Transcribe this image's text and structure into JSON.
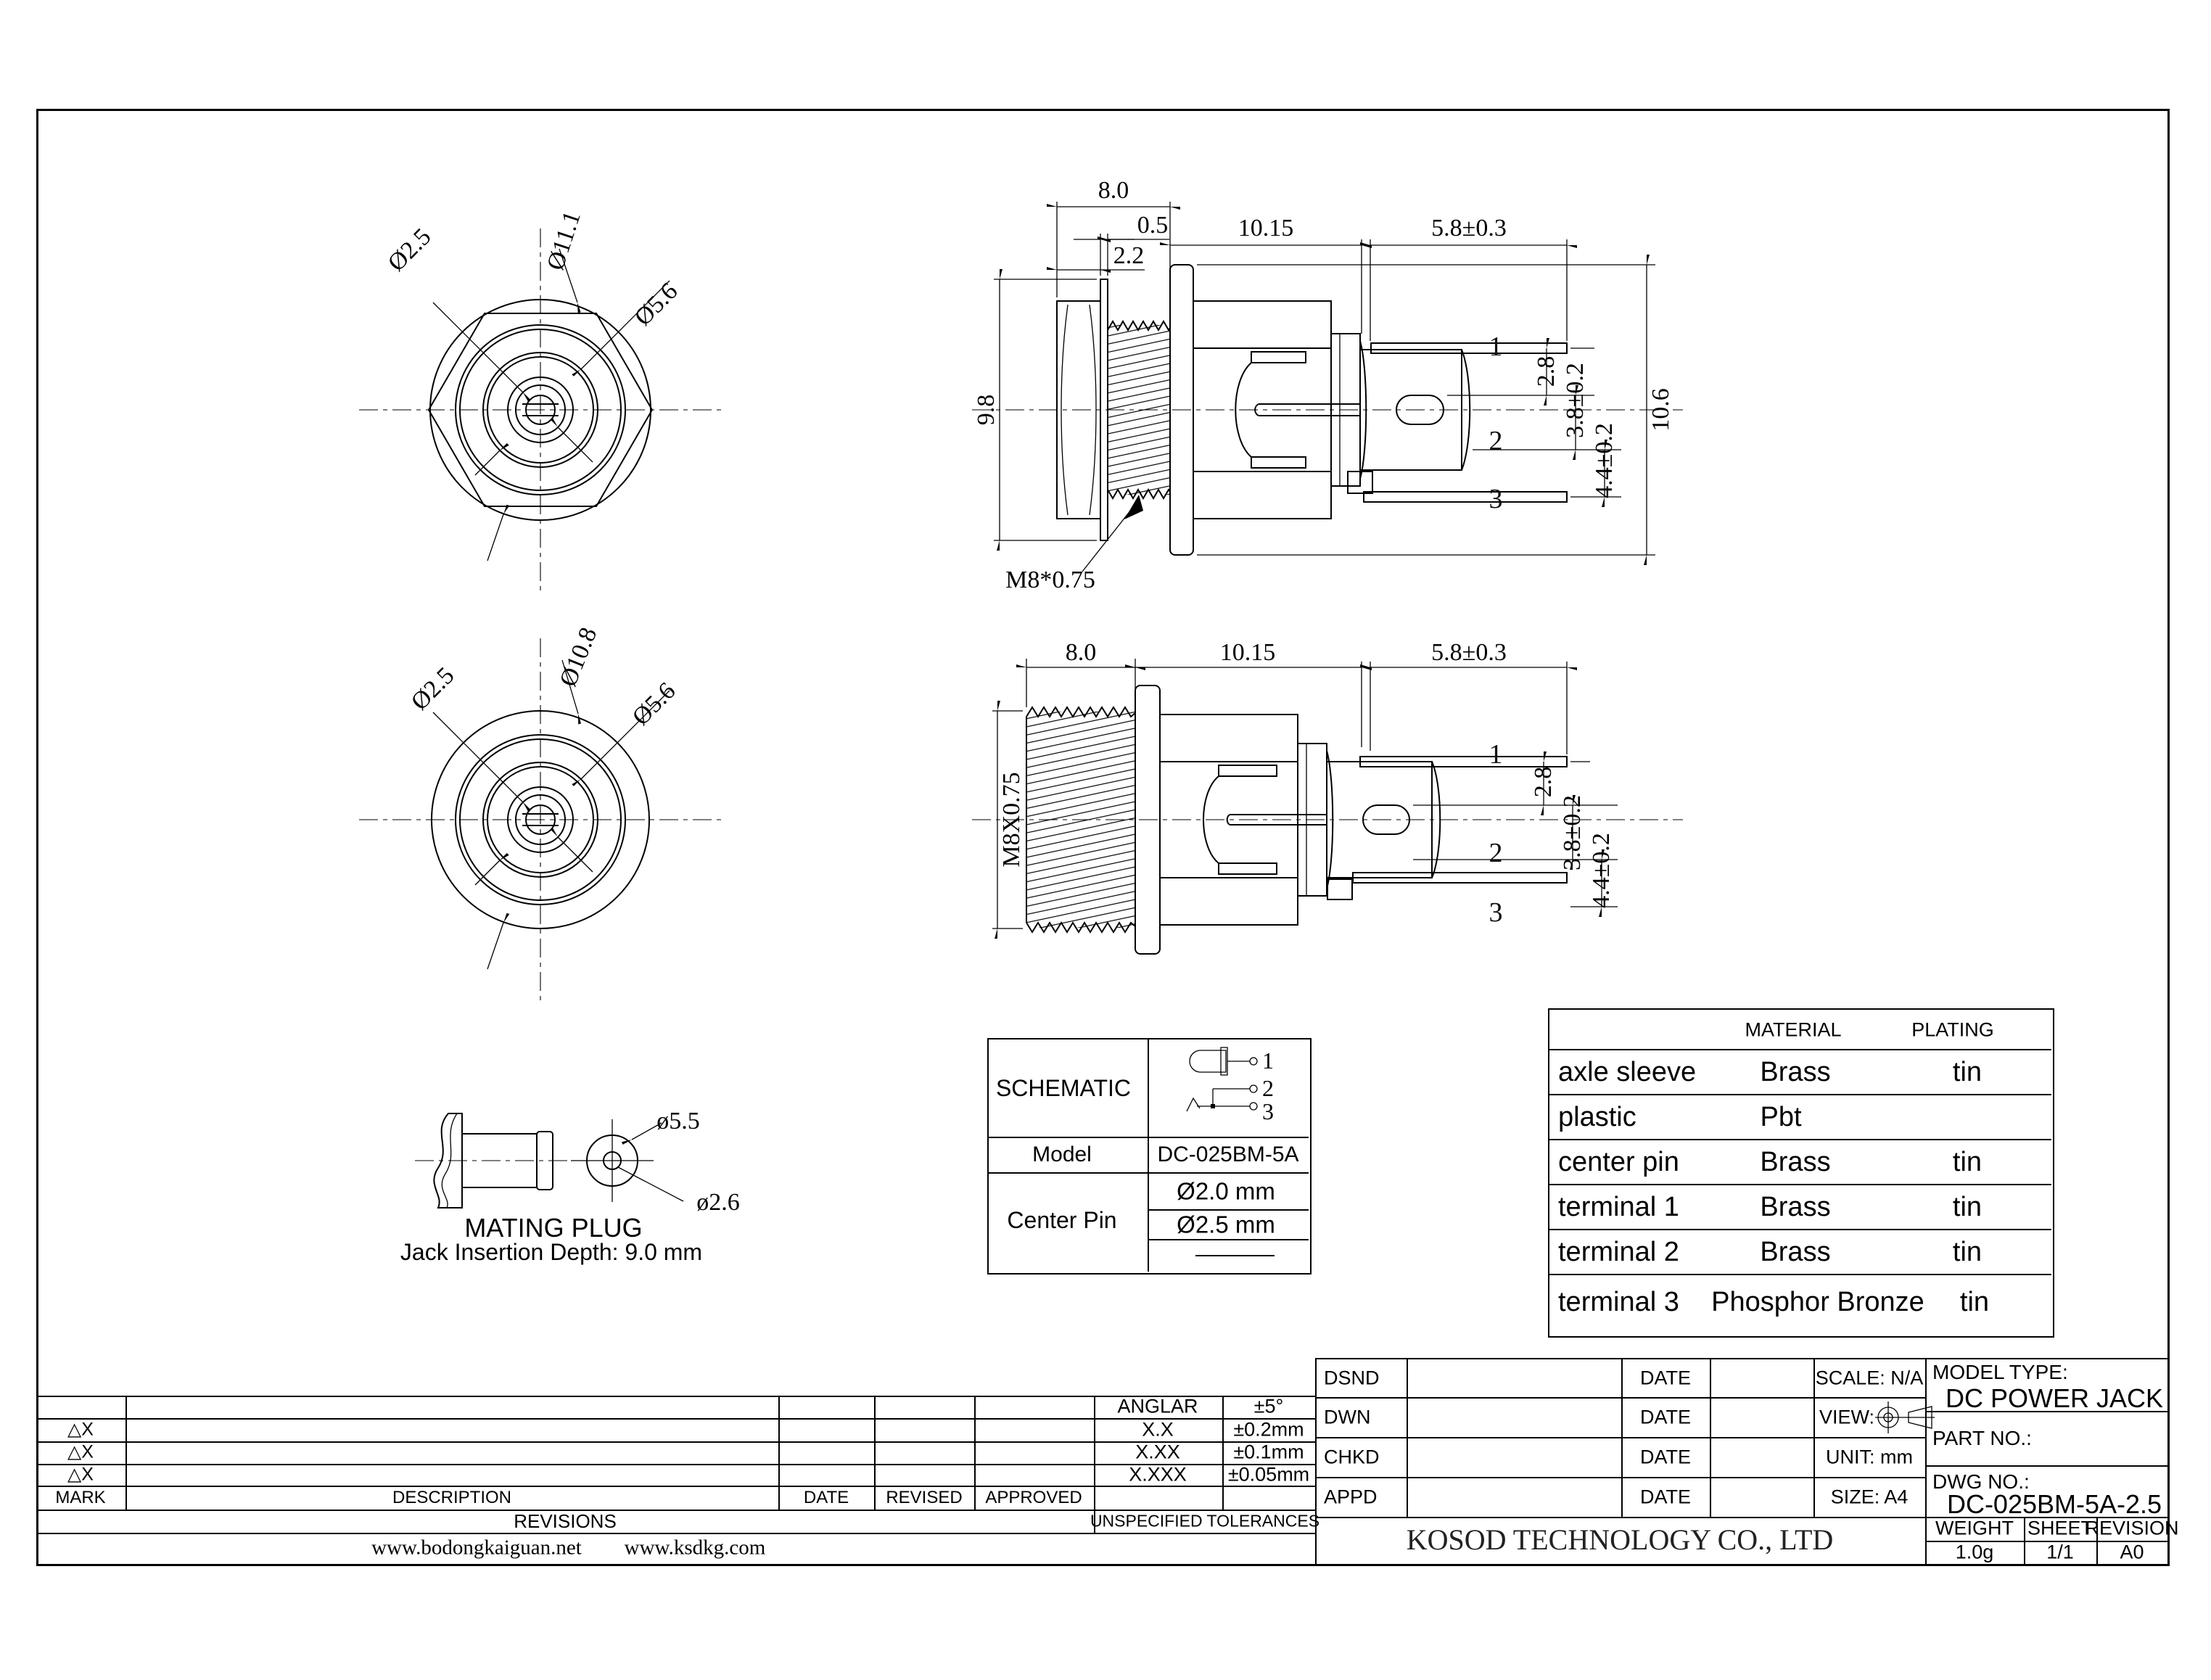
{
  "sheet": {
    "bg": "#ffffff",
    "ink": "#000000"
  },
  "views": {
    "hex_front": {
      "dia_small": "Ø2.5",
      "dia_outer": "Ø11.1",
      "dia_mid": "Ø5.6"
    },
    "side_panel": {
      "dim_nut_width": "8.0",
      "dim_washer": "0.5",
      "dim_nut": "2.2",
      "dim_body": "10.15",
      "dim_terminal": "5.8±0.3",
      "dim_nut_height": "9.8",
      "dim_t1_offset": "2.8",
      "dim_center": "3.8±0.2",
      "dim_t3_offset": "4.4±0.2",
      "dim_total_height": "10.6",
      "thread_spec": "M8*0.75",
      "pin1": "1",
      "pin2": "2",
      "pin3": "3"
    },
    "round_front": {
      "dia_small": "Ø2.5",
      "dia_outer": "Ø10.8",
      "dia_mid": "Ø5.6"
    },
    "side_thread": {
      "dim_thread_len": "8.0",
      "dim_body": "10.15",
      "dim_terminal": "5.8±0.3",
      "thread_spec": "M8X0.75",
      "dim_t1_offset": "2.8",
      "dim_center": "3.8±0.2",
      "dim_t3_offset": "4.4±0.2",
      "pin1": "1",
      "pin2": "2",
      "pin3": "3"
    },
    "mating_plug": {
      "dia_outer": "ø5.5",
      "dia_pin": "ø2.6",
      "title": "MATING PLUG",
      "insertion": "Jack Insertion Depth: 9.0 mm"
    }
  },
  "schematic": {
    "title": "SCHEMATIC",
    "pin1": "1",
    "pin2": "2",
    "pin3": "3",
    "model_label": "Model",
    "model": "DC-025BM-5A",
    "center_pin_label": "Center Pin",
    "center_pin_d1": "Ø2.0 mm",
    "center_pin_d2": "Ø2.5 mm"
  },
  "materials": {
    "material_header": "MATERIAL",
    "plating_header": "PLATING",
    "rows": [
      {
        "part": "axle sleeve",
        "material": "Brass",
        "plating": "tin"
      },
      {
        "part": "plastic",
        "material": "Pbt",
        "plating": ""
      },
      {
        "part": "center pin",
        "material": "Brass",
        "plating": "tin"
      },
      {
        "part": "terminal 1",
        "material": "Brass",
        "plating": "tin"
      },
      {
        "part": "terminal 2",
        "material": "Brass",
        "plating": "tin"
      },
      {
        "part": "terminal 3",
        "material": "Phosphor Bronze",
        "plating": "tin"
      }
    ]
  },
  "revisions": {
    "mark1": "△X",
    "mark2": "△X",
    "mark3": "△X",
    "mark_header": "MARK",
    "description_header": "DESCRIPTION",
    "date_header": "DATE",
    "revised_header": "REVISED",
    "approved_header": "APPROVED",
    "title": "REVISIONS",
    "site1": "www.bodongkaiguan.net",
    "site2": "www.ksdkg.com"
  },
  "tolerances": {
    "title": "UNSPECIFIED TOLERANCES",
    "r1_name": "ANGLAR",
    "r1_val": "±5°",
    "r2_name": "X.X",
    "r2_val": "±0.2mm",
    "r3_name": "X.XX",
    "r3_val": "±0.1mm",
    "r4_name": "X.XXX",
    "r4_val": "±0.05mm"
  },
  "approvals": {
    "dsnd": "DSND",
    "dwn": "DWN",
    "chkd": "CHKD",
    "appd": "APPD",
    "date1": "DATE",
    "date2": "DATE",
    "date3": "DATE",
    "date4": "DATE",
    "scale": "SCALE: N/A",
    "view": "VIEW:",
    "unit": "UNIT: mm",
    "size": "SIZE: A4"
  },
  "company": {
    "name": "KOSOD TECHNOLOGY CO., LTD"
  },
  "title_info": {
    "model_type_label": "MODEL TYPE:",
    "model_type": "DC POWER JACK",
    "part_no_label": "PART NO.:",
    "dwg_no_label": "DWG NO.:",
    "dwg_no": "DC-025BM-5A-2.5",
    "weight_label": "WEIGHT",
    "weight": "1.0g",
    "sheet_label": "SHEET",
    "sheet": "1/1",
    "revision_label": "REVISION",
    "revision": "A0"
  }
}
